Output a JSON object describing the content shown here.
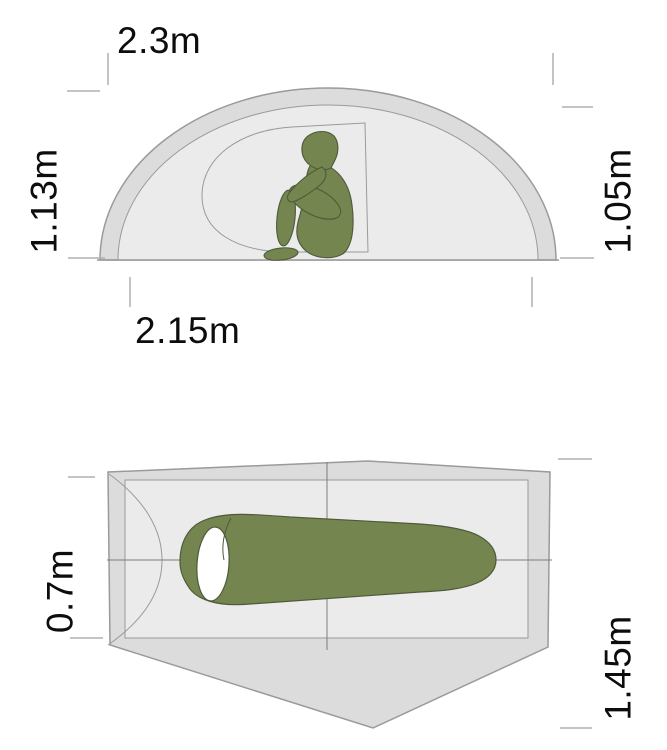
{
  "diagram": {
    "subject": "tent-dimensions",
    "views": [
      {
        "id": "side-view",
        "silhouette": "seated-person"
      },
      {
        "id": "top-view",
        "silhouette": "sleeping-bag"
      }
    ]
  },
  "labels": {
    "side_view_top": "2.3m",
    "side_view_left": "1.13m",
    "side_view_right": "1.05m",
    "side_view_bottom": "2.15m",
    "top_view_left": "0.7m",
    "top_view_right": "1.45m"
  },
  "colors": {
    "background": "#ffffff",
    "fly_band": "#dcdcdc",
    "inner_area": "#ebebeb",
    "outline": "#9a9a9a",
    "crosshair": "#7d7d7d",
    "tick": "#b0b0b0",
    "green": "#75854f",
    "green_outline": "#4e5a39",
    "opening_white": "#ffffff",
    "text": "#0d0d0d"
  }
}
